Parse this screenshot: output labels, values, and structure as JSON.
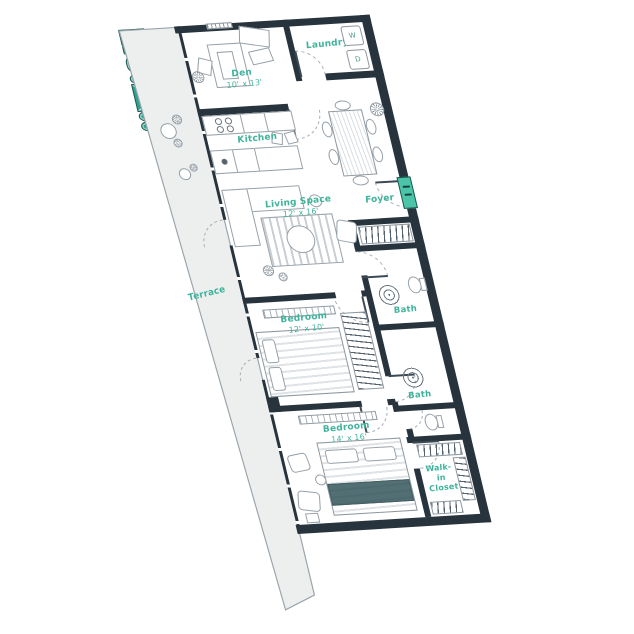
{
  "rooms": {
    "terrace": {
      "label": "Terrace"
    },
    "den": {
      "label": "Den",
      "dims": "10' x 13'"
    },
    "laundry": {
      "label": "Laundry"
    },
    "kitchen": {
      "label": "Kitchen"
    },
    "living_space": {
      "label": "Living Space",
      "dims": "12' x 16'"
    },
    "foyer": {
      "label": "Foyer"
    },
    "bath_1": {
      "label": "Bath"
    },
    "bedroom_1": {
      "label": "Bedroom",
      "dims": "12' x 10'"
    },
    "bath_2": {
      "label": "Bath"
    },
    "bedroom_2": {
      "label": "Bedroom",
      "dims": "14' x 16'"
    },
    "walk_in_closet": {
      "label": "Walk-in Closet"
    }
  },
  "appliances": {
    "washer": "W",
    "dryer": "D"
  },
  "colors": {
    "wall": "#27333d",
    "fixture_teal": "#2fa390",
    "label_teal": "#3fb39b",
    "terrace_fill": "#edefef",
    "furniture_outline": "#97a1a8"
  }
}
